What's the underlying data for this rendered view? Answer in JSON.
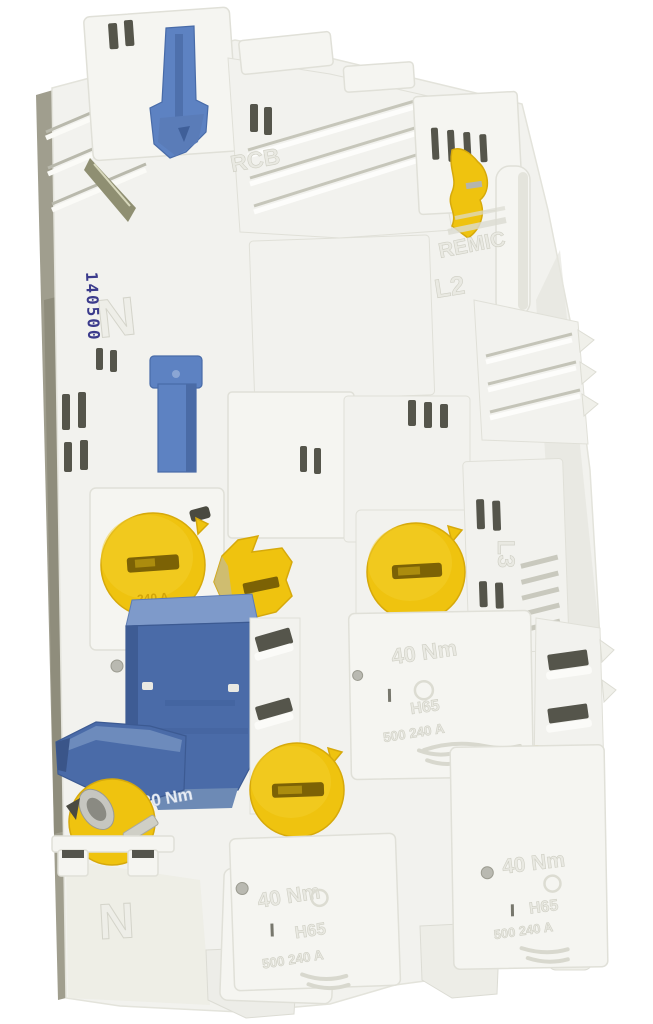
{
  "image": {
    "type": "photograph",
    "subject": "White plastic NH fuse distribution block with yellow screw caps and blue switch levers",
    "background": "#ffffff"
  },
  "colors": {
    "body_white": "#f5f5f1",
    "shadow_gray": "#a09e8e",
    "vent_slot": "#55554b",
    "cap_yellow": "#efc30f",
    "cap_yellow_dark": "#d6a90b",
    "lever_blue": "#5d82c2",
    "block_blue": "#4a6ba8",
    "stamp_ink": "#3b3b8c",
    "emboss_light": "#e9e9e2"
  },
  "markings": {
    "serial_stamp": "140500",
    "neutral_top": "N",
    "brand_top": "RCB",
    "brand_mid": "REMIC",
    "phase_l2": "L2",
    "phase_l3": "L3",
    "neutral_bottom": "N",
    "torque_block": "30 Nm",
    "cover_torque": "40 Nm",
    "cover_code": "H65",
    "cover_rating": "500 240 A",
    "cap_rating": "240 A"
  }
}
